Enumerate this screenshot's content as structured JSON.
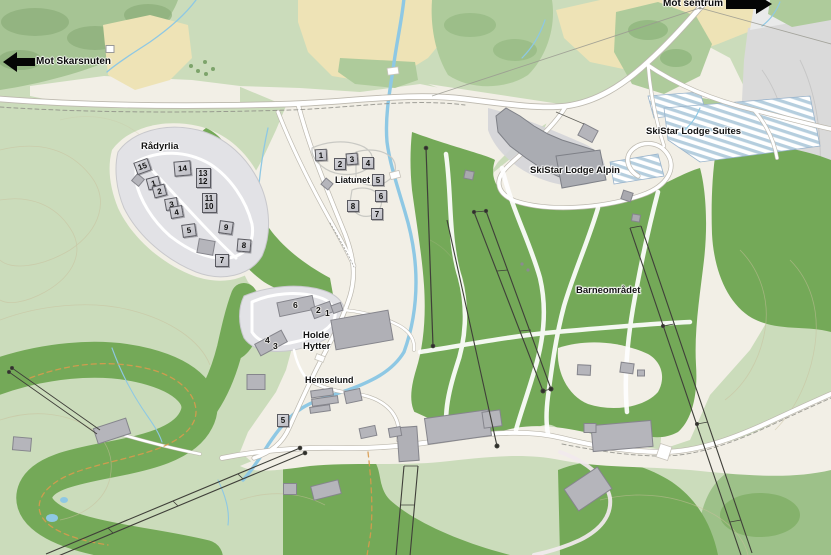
{
  "directions": [
    {
      "id": "mot-skarsnuten",
      "label": "Mot Skarsnuten",
      "arrow": "left",
      "text_x": 36,
      "text_y": 56,
      "arrow_x": 3,
      "arrow_y": 51
    },
    {
      "id": "mot-sentrum",
      "label": "Mot sentrum",
      "arrow": "right",
      "text_x": 663,
      "text_y": -2,
      "arrow_x": 726,
      "arrow_y": -6
    }
  ],
  "area_labels": [
    {
      "id": "radyrlia",
      "text": "Rådyrlia",
      "x": 141,
      "y": 142,
      "size": 9.5
    },
    {
      "id": "liatunet",
      "text": "Liatunet",
      "x": 335,
      "y": 175,
      "size": 9
    },
    {
      "id": "skistar-lodge-suites",
      "text": "SkiStar Lodge Suites",
      "x": 646,
      "y": 127,
      "size": 9.5
    },
    {
      "id": "skistar-lodge-alpin",
      "text": "SkiStar Lodge Alpin",
      "x": 530,
      "y": 166,
      "size": 9.5
    },
    {
      "id": "barneomradet",
      "text": "Barneområdet",
      "x": 576,
      "y": 286,
      "size": 9.5
    },
    {
      "id": "holde-hytter",
      "text": "Holde\nHytter",
      "x": 303,
      "y": 331,
      "size": 9.5
    },
    {
      "id": "hemselund",
      "text": "Hemselund",
      "x": 305,
      "y": 375,
      "size": 9
    }
  ],
  "plot_markers": {
    "radyrlia": [
      {
        "n": "15",
        "x": 142,
        "y": 166,
        "rot": -20,
        "style": "box",
        "w": 15,
        "h": 13
      },
      {
        "n": "14",
        "x": 182,
        "y": 168,
        "rot": -5,
        "style": "box",
        "w": 17,
        "h": 15
      },
      {
        "n": "1",
        "x": 153,
        "y": 183,
        "rot": -15,
        "style": "box"
      },
      {
        "n": "2",
        "x": 159,
        "y": 191,
        "rot": -15,
        "style": "box"
      },
      {
        "lines": [
          "13",
          "12"
        ],
        "x": 203,
        "y": 178,
        "style": "box2"
      },
      {
        "n": "3",
        "x": 171,
        "y": 204,
        "rot": -10,
        "style": "box"
      },
      {
        "n": "4",
        "x": 176,
        "y": 212,
        "rot": -10,
        "style": "box"
      },
      {
        "lines": [
          "11",
          "10"
        ],
        "x": 209,
        "y": 203,
        "style": "box2"
      },
      {
        "n": "5",
        "x": 189,
        "y": 230,
        "rot": -8,
        "style": "box",
        "w": 14,
        "h": 13
      },
      {
        "n": "9",
        "x": 226,
        "y": 227,
        "rot": 8,
        "style": "box",
        "w": 14,
        "h": 13
      },
      {
        "n": "8",
        "x": 244,
        "y": 245,
        "rot": 5,
        "style": "box",
        "w": 14,
        "h": 13
      },
      {
        "n": "7",
        "x": 222,
        "y": 260,
        "rot": 0,
        "style": "box",
        "w": 14,
        "h": 13
      }
    ],
    "liatunet": [
      {
        "n": "1",
        "x": 321,
        "y": 155,
        "rot": -3,
        "style": "box",
        "w": 12,
        "h": 12
      },
      {
        "n": "2",
        "x": 340,
        "y": 164,
        "rot": 0,
        "style": "box",
        "w": 12,
        "h": 12
      },
      {
        "n": "3",
        "x": 352,
        "y": 159,
        "rot": -5,
        "style": "box",
        "w": 12,
        "h": 12
      },
      {
        "n": "4",
        "x": 368,
        "y": 163,
        "rot": 0,
        "style": "box",
        "w": 12,
        "h": 12
      },
      {
        "n": "5",
        "x": 378,
        "y": 180,
        "rot": 0,
        "style": "box",
        "w": 12,
        "h": 12
      },
      {
        "n": "6",
        "x": 381,
        "y": 196,
        "rot": 0,
        "style": "box",
        "w": 12,
        "h": 12
      },
      {
        "n": "8",
        "x": 353,
        "y": 206,
        "rot": 0,
        "style": "box",
        "w": 12,
        "h": 12
      },
      {
        "n": "7",
        "x": 377,
        "y": 214,
        "rot": 0,
        "style": "box",
        "w": 12,
        "h": 12
      }
    ],
    "holde_hytter": [
      {
        "n": "6",
        "x": 296,
        "y": 305,
        "style": "num"
      },
      {
        "n": "2",
        "x": 319,
        "y": 310,
        "style": "num"
      },
      {
        "n": "1",
        "x": 328,
        "y": 313,
        "style": "num"
      },
      {
        "n": "4",
        "x": 268,
        "y": 340,
        "style": "num"
      },
      {
        "n": "3",
        "x": 276,
        "y": 346,
        "style": "num"
      }
    ],
    "hemselund": [
      {
        "n": "5",
        "x": 283,
        "y": 420,
        "rot": 0,
        "style": "box",
        "w": 12,
        "h": 13
      }
    ]
  },
  "colors": {
    "base_green": "#cbdcbb",
    "forest_green": "#a6c494",
    "forest_blob": "#8bae79",
    "slope_green": "#74a958",
    "medium_green": "#aecb9b",
    "open_beige": "#f2efe6",
    "farmland_yellow": "#eee3b6",
    "gray_area": "#dadada",
    "building_gray": "#b5b5bb",
    "building_outline": "#85858c",
    "road_fill": "#ffffff",
    "road_casing": "#bcb8ae",
    "river_blue": "#8ec8e4",
    "parking_stripe_blue": "#b5cede",
    "lift_dark": "#3f3f39",
    "trail_orange": "#d89a4e",
    "contour_tan": "#c9bf9d",
    "marker_fill": "#c9c9cf",
    "marker_border": "#5a5a61",
    "label_black": "#121212",
    "arrow_black": "#050505"
  }
}
